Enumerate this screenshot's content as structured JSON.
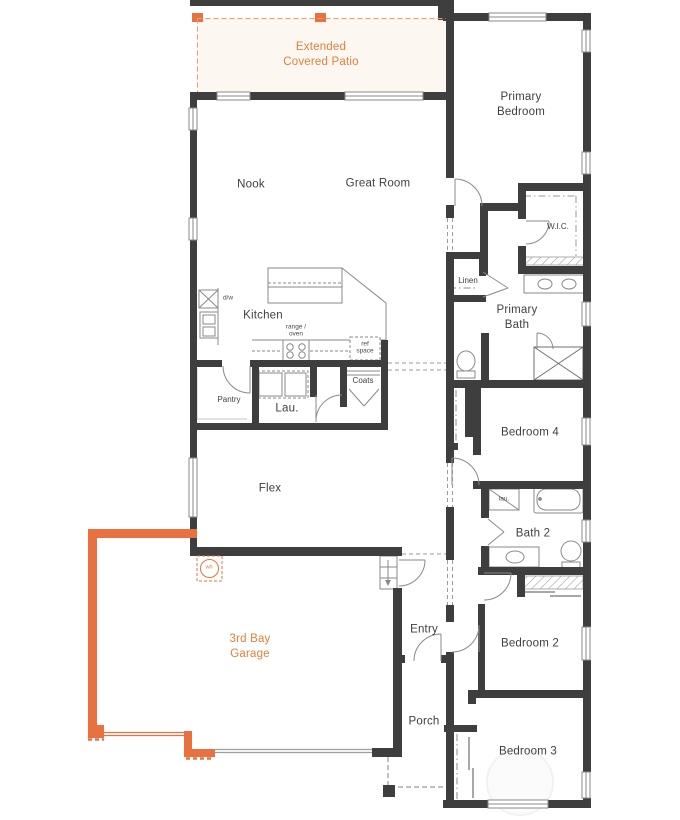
{
  "colors": {
    "wall": "#3e3e3e",
    "option_wall": "#e8713f",
    "label_text": "#3f3f3f",
    "option_label": "#e0813c",
    "fixture_line": "#8a8a8a"
  },
  "labels": {
    "patio": "Extended Covered Patio",
    "primary_bedroom": "Primary Bedroom",
    "nook": "Nook",
    "great_room": "Great Room",
    "wic": "W.I.C.",
    "linen": "Linen",
    "kitchen": "Kitchen",
    "primary_bath": "Primary Bath",
    "pantry": "Pantry",
    "laundry": "Lau.",
    "coats": "Coats",
    "bedroom4": "Bedroom 4",
    "flex": "Flex",
    "bath2": "Bath 2",
    "garage": "3rd Bay Garage",
    "entry": "Entry",
    "bedroom2": "Bedroom 2",
    "porch": "Porch",
    "bedroom3": "Bedroom 3"
  },
  "annotations": {
    "dishwasher": "d/w",
    "range_oven": "range / oven",
    "ref_space": "ref space",
    "water_heater": "wh",
    "bath2_cabinet": "lau."
  }
}
